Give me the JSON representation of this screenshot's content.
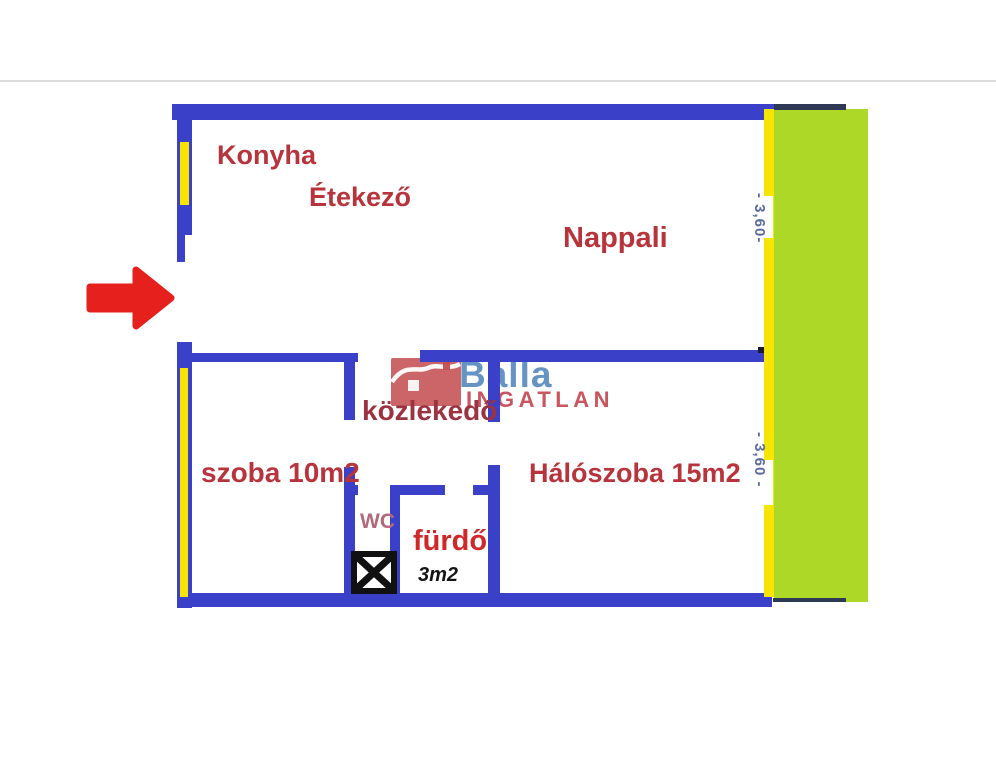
{
  "plan": {
    "rooms": {
      "konyha": "Konyha",
      "etekezo": "Étekező",
      "nappali": "Nappali",
      "kozlekedo": "közlekedő",
      "szoba": "szoba 10m2",
      "haloszoba": "Hálószoba 15m2",
      "wc": "WC",
      "furdo": "fürdő",
      "furdo_size": "3m2"
    },
    "dimensions": {
      "right_upper": "- 3,60-",
      "right_lower": "- 3,60 -"
    },
    "icons": {
      "entrance_arrow": "red right-pointing entrance arrow",
      "shaft": "crossed-box shaft symbol",
      "windows": "yellow window strips",
      "balcony": "green balcony band"
    }
  },
  "logo": {
    "brand": "Balla",
    "brand_sub": "INGATLAN",
    "icon": "house-logo"
  },
  "colors": {
    "wall": "#3a41c8",
    "wall_dark_edge": "#2e3a55",
    "window": "#f7e400",
    "balcony": "#aed827",
    "arrow": "#e5201d",
    "room_label": "#b8343c",
    "furdo_label": "#d02828",
    "wc_label": "#b2697a",
    "dimension_label": "#5a6a9c",
    "logo_blue": "#5a8cc0",
    "logo_red": "#c4434e"
  }
}
